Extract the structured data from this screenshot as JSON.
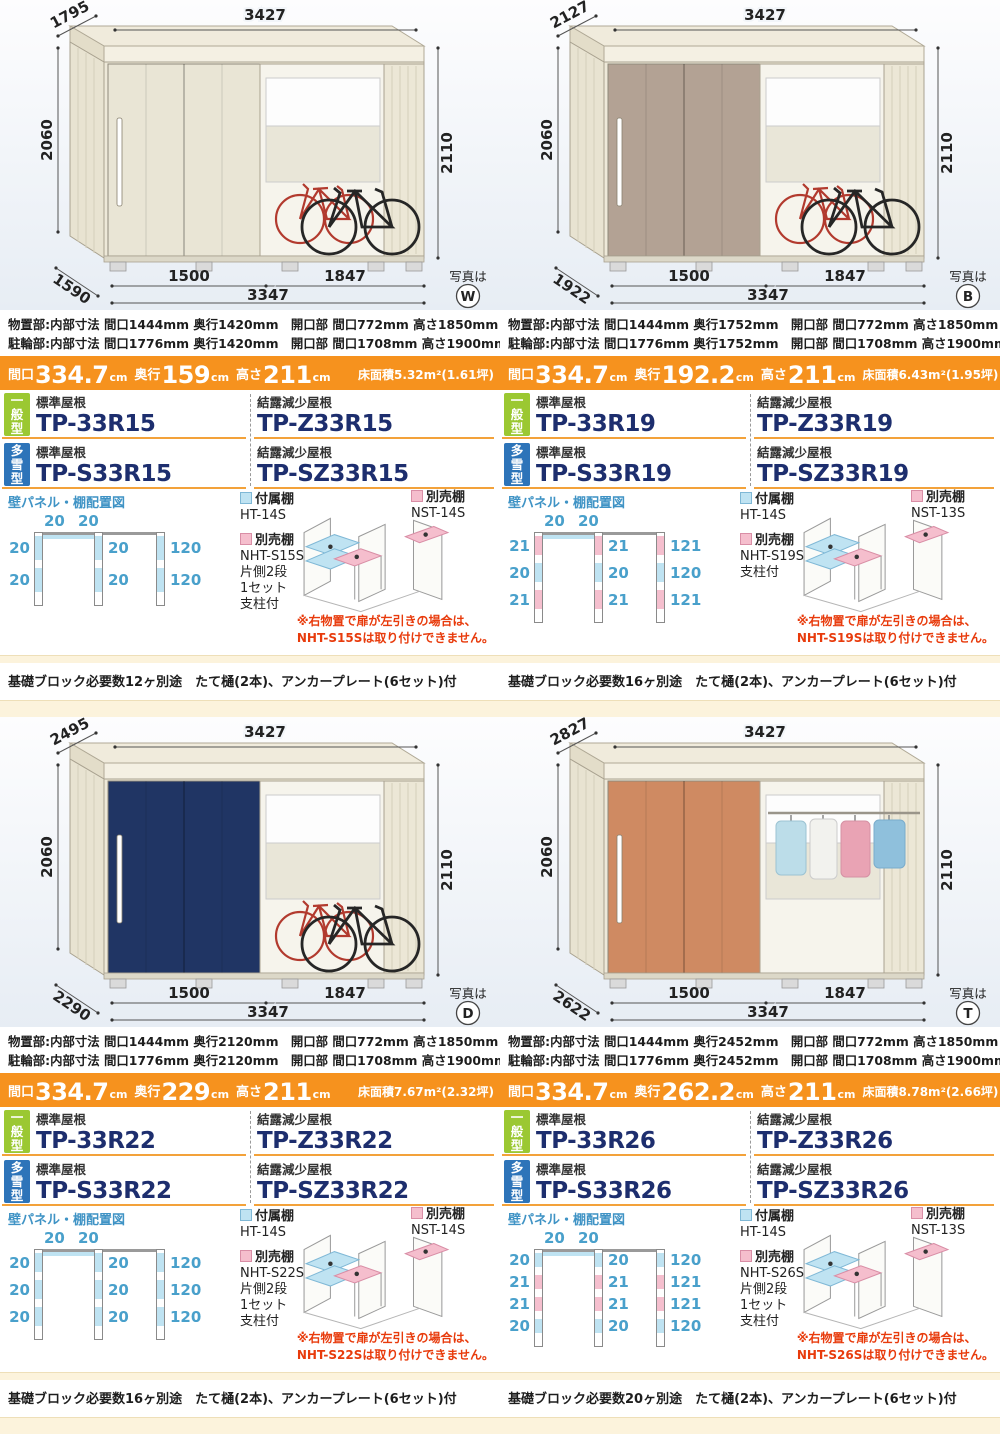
{
  "labels": {
    "ippan": "一般型",
    "tasetsu": "多雪型",
    "std_roof": "標準屋根",
    "dew_roof": "結露減少屋根",
    "panel_title": "壁パネル・棚配置図",
    "attached": "付属棚",
    "optional": "別売棚",
    "photo": "写真は",
    "maguchi": "間口",
    "okuyuki": "奥行",
    "takasa": "高さ",
    "cm": "cm"
  },
  "cards": [
    {
      "photo_letter": "W",
      "door_color": "#e9e5d5",
      "bay": "bikes",
      "dims": {
        "roof_depth": "1795",
        "roof_width": "3427",
        "height_left": "2060",
        "height_right": "2110",
        "base_depth": "1590",
        "bay1": "1500",
        "bay2": "1847",
        "base_width": "3347"
      },
      "spec1": "物置部:内部寸法 間口1444mm 奥行1420mm　開口部 間口772mm 高さ1850mm",
      "spec2": "駐輪部:内部寸法 間口1776mm 奥行1420mm　開口部 間口1708mm 高さ1900mm(基礎天)",
      "banner": {
        "maguchi": "334.7",
        "okuyuki": "159",
        "takasa": "211",
        "floor": "床面積5.32m²(1.61坪)"
      },
      "models": {
        "std": "TP-33R15",
        "dew": "TP-Z33R15",
        "snow_std": "TP-S33R15",
        "snow_dew": "TP-SZ33R15"
      },
      "diagram": {
        "top": [
          "20",
          "20"
        ],
        "left": [
          "20",
          "20"
        ],
        "mid": [
          "20",
          "20"
        ],
        "right": [
          "120",
          "120"
        ]
      },
      "attached_model": "HT-14S",
      "optional_lines": [
        "NHT-S15S",
        "片側2段",
        "1セット",
        "支柱付"
      ],
      "nst_model": "NST-14S",
      "warning": [
        "※右物置で扉が左引きの場合は、",
        "NHT-S15Sは取り付けできません。"
      ],
      "footer": "基礎ブロック必要数12ヶ別途　たて樋(2本)、アンカープレート(6セット)付"
    },
    {
      "photo_letter": "B",
      "door_color": "#b3a294",
      "bay": "bikes",
      "dims": {
        "roof_depth": "2127",
        "roof_width": "3427",
        "height_left": "2060",
        "height_right": "2110",
        "base_depth": "1922",
        "bay1": "1500",
        "bay2": "1847",
        "base_width": "3347"
      },
      "spec1": "物置部:内部寸法 間口1444mm 奥行1752mm　開口部 間口772mm 高さ1850mm",
      "spec2": "駐輪部:内部寸法 間口1776mm 奥行1752mm　開口部 間口1708mm 高さ1900mm(基礎天)",
      "banner": {
        "maguchi": "334.7",
        "okuyuki": "192.2",
        "takasa": "211",
        "floor": "床面積6.43m²(1.95坪)"
      },
      "models": {
        "std": "TP-33R19",
        "dew": "TP-Z33R19",
        "snow_std": "TP-S33R19",
        "snow_dew": "TP-SZ33R19"
      },
      "diagram": {
        "top": [
          "20",
          "20"
        ],
        "left": [
          "21",
          "20",
          "21"
        ],
        "mid": [
          "21",
          "20",
          "21"
        ],
        "right": [
          "121",
          "120",
          "121"
        ]
      },
      "attached_model": "HT-14S",
      "optional_lines": [
        "NHT-S19S",
        "支柱付"
      ],
      "nst_model": "NST-13S",
      "warning": [
        "※右物置で扉が左引きの場合は、",
        "NHT-S19Sは取り付けできません。"
      ],
      "footer": "基礎ブロック必要数16ヶ別途　たて樋(2本)、アンカープレート(6セット)付"
    },
    {
      "photo_letter": "D",
      "door_color": "#203564",
      "bay": "bikes",
      "dims": {
        "roof_depth": "2495",
        "roof_width": "3427",
        "height_left": "2060",
        "height_right": "2110",
        "base_depth": "2290",
        "bay1": "1500",
        "bay2": "1847",
        "base_width": "3347"
      },
      "spec1": "物置部:内部寸法 間口1444mm 奥行2120mm　開口部 間口772mm 高さ1850mm",
      "spec2": "駐輪部:内部寸法 間口1776mm 奥行2120mm　開口部 間口1708mm 高さ1900mm(基礎天)",
      "banner": {
        "maguchi": "334.7",
        "okuyuki": "229",
        "takasa": "211",
        "floor": "床面積7.67m²(2.32坪)"
      },
      "models": {
        "std": "TP-33R22",
        "dew": "TP-Z33R22",
        "snow_std": "TP-S33R22",
        "snow_dew": "TP-SZ33R22"
      },
      "diagram": {
        "top": [
          "20",
          "20"
        ],
        "left": [
          "20",
          "20",
          "20"
        ],
        "mid": [
          "20",
          "20",
          "20"
        ],
        "right": [
          "120",
          "120",
          "120"
        ]
      },
      "attached_model": "HT-14S",
      "optional_lines": [
        "NHT-S22S",
        "片側2段",
        "1セット",
        "支柱付"
      ],
      "nst_model": "NST-14S",
      "warning": [
        "※右物置で扉が左引きの場合は、",
        "NHT-S22Sは取り付けできません。"
      ],
      "footer": "基礎ブロック必要数16ヶ別途　たて樋(2本)、アンカープレート(6セット)付"
    },
    {
      "photo_letter": "T",
      "door_color": "#cf8a62",
      "bay": "clothes",
      "dims": {
        "roof_depth": "2827",
        "roof_width": "3427",
        "height_left": "2060",
        "height_right": "2110",
        "base_depth": "2622",
        "bay1": "1500",
        "bay2": "1847",
        "base_width": "3347"
      },
      "spec1": "物置部:内部寸法 間口1444mm 奥行2452mm　開口部 間口772mm 高さ1850mm",
      "spec2": "駐輪部:内部寸法 間口1776mm 奥行2452mm　開口部 間口1708mm 高さ1900mm(基礎天)",
      "banner": {
        "maguchi": "334.7",
        "okuyuki": "262.2",
        "takasa": "211",
        "floor": "床面積8.78m²(2.66坪)"
      },
      "models": {
        "std": "TP-33R26",
        "dew": "TP-Z33R26",
        "snow_std": "TP-S33R26",
        "snow_dew": "TP-SZ33R26"
      },
      "diagram": {
        "top": [
          "20",
          "20"
        ],
        "left": [
          "20",
          "21",
          "21",
          "20"
        ],
        "mid": [
          "20",
          "21",
          "21",
          "20"
        ],
        "right": [
          "120",
          "121",
          "121",
          "120"
        ]
      },
      "attached_model": "HT-14S",
      "optional_lines": [
        "NHT-S26S",
        "片側2段",
        "1セット",
        "支柱付"
      ],
      "nst_model": "NST-13S",
      "warning": [
        "※右物置で扉が左引きの場合は、",
        "NHT-S26Sは取り付けできません。"
      ],
      "footer": "基礎ブロック必要数20ヶ別途　たて樋(2本)、アンカープレート(6セット)付"
    }
  ]
}
